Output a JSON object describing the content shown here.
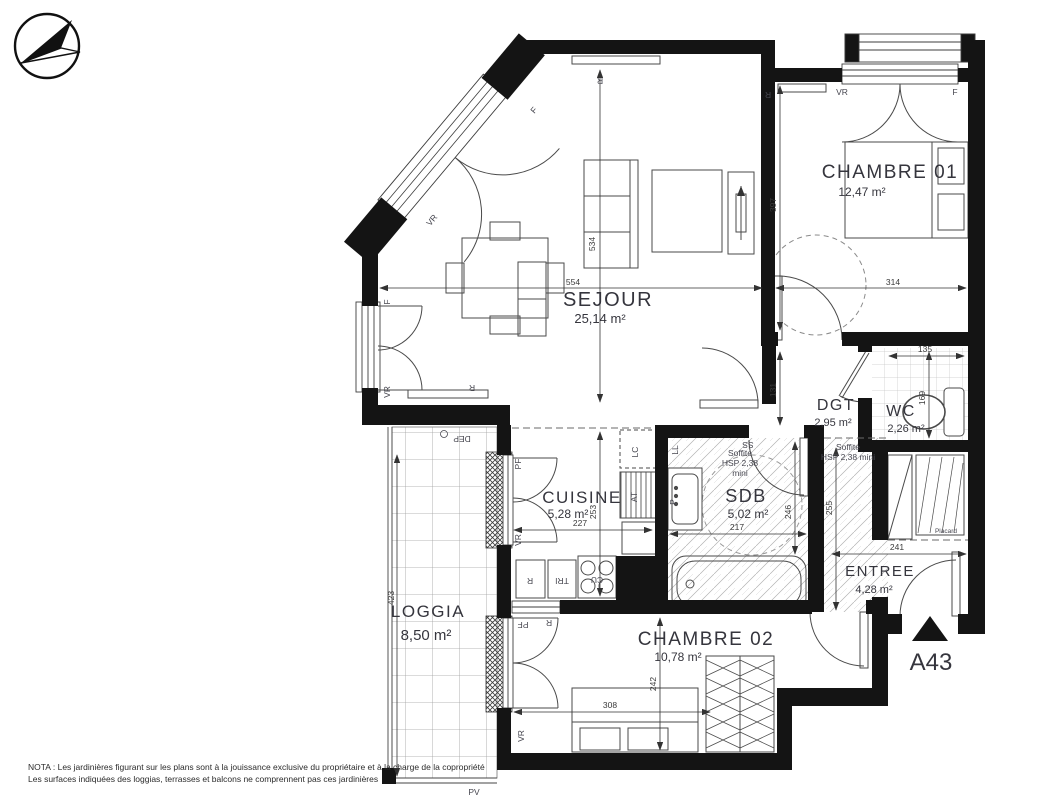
{
  "rooms": {
    "chambre01": {
      "name": "CHAMBRE 01",
      "area": "12,47 m²"
    },
    "sejour": {
      "name": "SEJOUR",
      "area": "25,14 m²"
    },
    "dgt": {
      "name": "DGT",
      "area": "2,95 m²"
    },
    "wc": {
      "name": "WC",
      "area": "2,26 m²"
    },
    "cuisine": {
      "name": "CUISINE",
      "area": "5,28 m²"
    },
    "sdb": {
      "name": "SDB",
      "area": "5,02 m²"
    },
    "entree": {
      "name": "ENTREE",
      "area": "4,28 m²"
    },
    "loggia": {
      "name": "LOGGIA",
      "area": "8,50 m²"
    },
    "chambre02": {
      "name": "CHAMBRE 02",
      "area": "10,78 m²"
    }
  },
  "dims": {
    "sejour_w": "554",
    "chambre01_w": "314",
    "sejour_h": "534",
    "chambre01_h": "397",
    "passage": "131",
    "wc_w": "135",
    "wc_h": "169",
    "cuisine_w": "227",
    "cuisine_h": "253",
    "sdb_w": "217",
    "sdb_h": "246",
    "entree_w": "241",
    "entree_h": "255",
    "chambre02_w": "308",
    "chambre02_h": "242",
    "loggia_h": "423"
  },
  "labels": {
    "vr": "VR",
    "f": "F",
    "r": "R",
    "pf": "PF",
    "pv": "PV",
    "dep": "DEP",
    "lc": "LC",
    "at": "AT",
    "ll": "LL",
    "ss": "SS",
    "p": "P",
    "cu": "CU",
    "tri": "TRI",
    "placard": "Placard"
  },
  "soffite_sdb": {
    "l1": "Soffite",
    "l2": "HSP 2,38",
    "l3": "mini"
  },
  "soffite_dgt": {
    "l1": "Soffite",
    "l2": "HSP 2,38 mini"
  },
  "entrance": {
    "label": "A43"
  },
  "nota": {
    "line1": "NOTA : Les jardinières figurant sur les plans sont à la jouissance exclusive du propriétaire et à la charge de la copropriété",
    "line2": "Les surfaces indiquées des loggias, terrasses et balcons ne comprennent pas ces jardinières"
  }
}
